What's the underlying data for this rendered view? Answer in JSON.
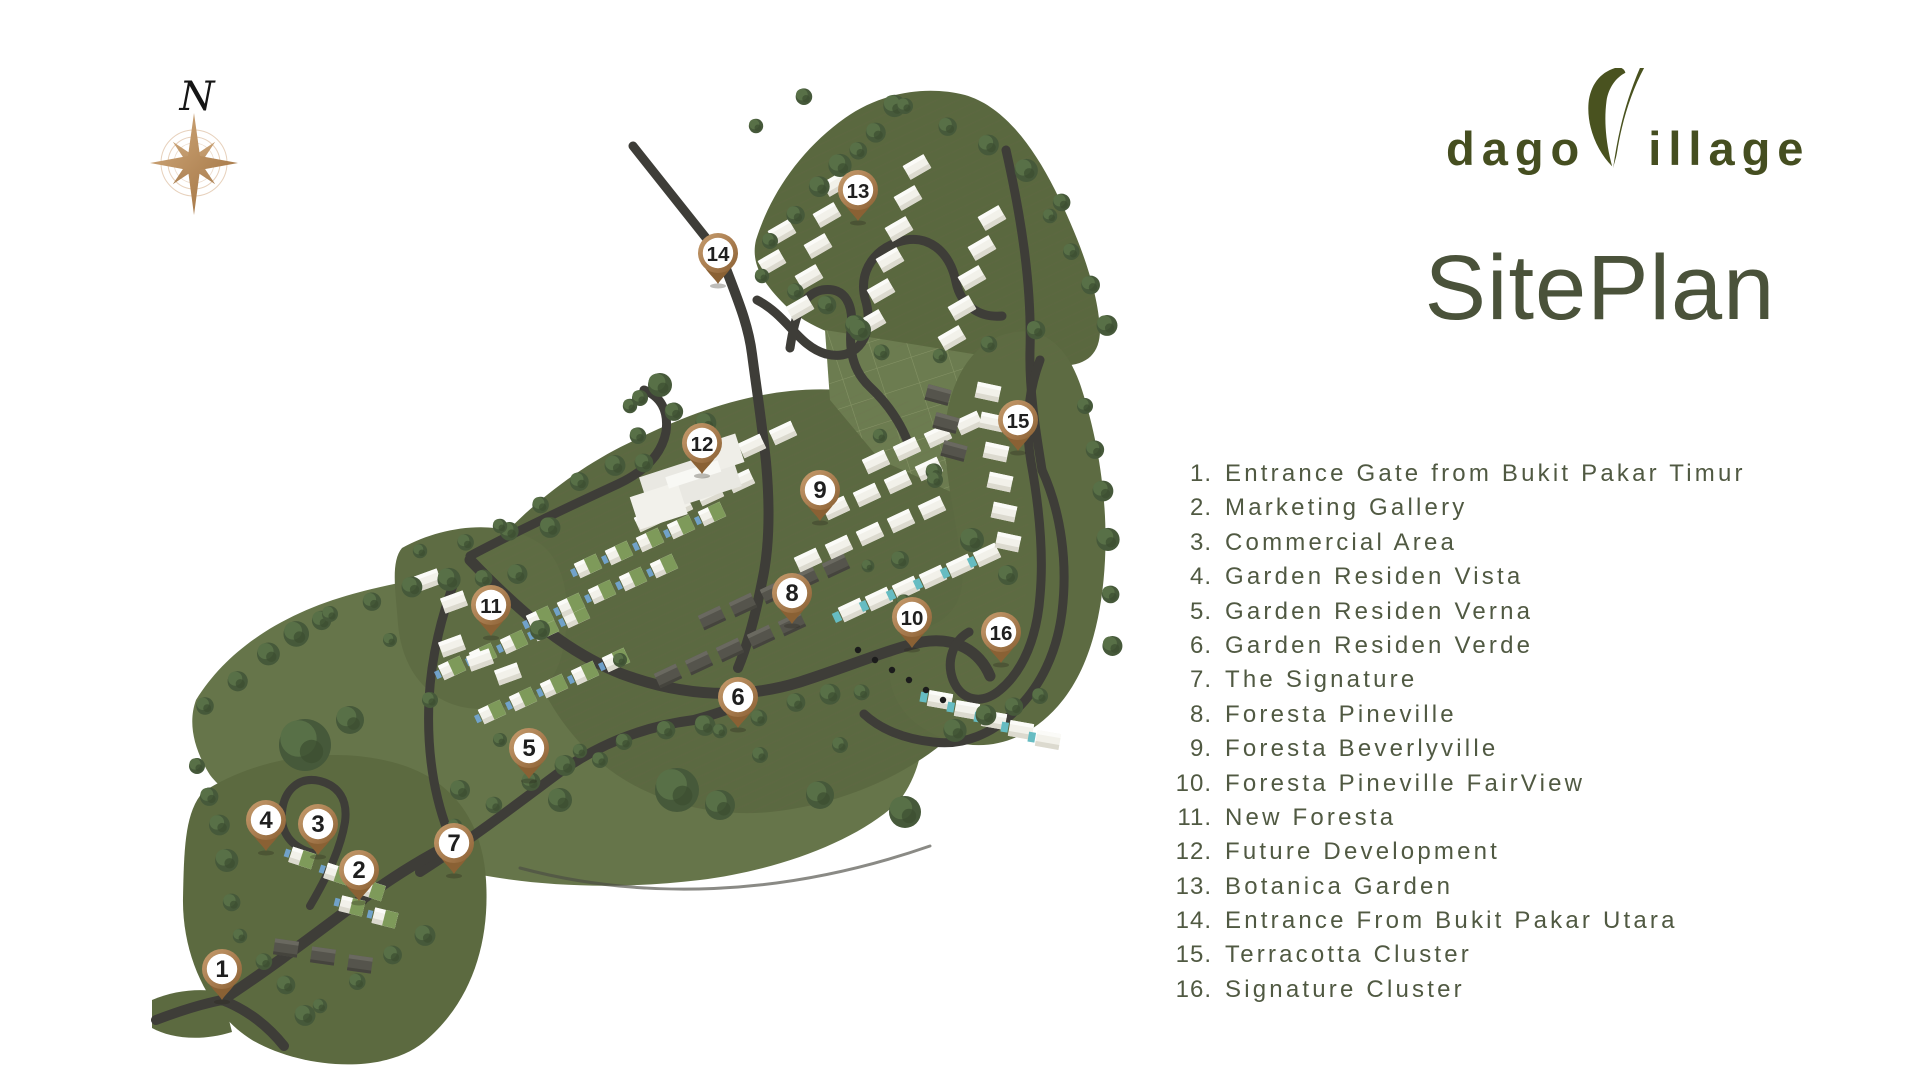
{
  "compass": {
    "label": "N"
  },
  "brand": {
    "logo_prefix": "dago",
    "logo_suffix": "illage",
    "title": "SitePlan"
  },
  "colors": {
    "brand_green": "#4a5228",
    "title_green": "#4a523a",
    "legend_green": "#505942",
    "pin_bronze": "#a87c4f",
    "pin_bronze_dark": "#8a6134",
    "road_gray": "#3e3d38",
    "terrain_green": "#5d6b41",
    "compass_bronze": "#bd8a58"
  },
  "legend": {
    "items": [
      {
        "num": "1.",
        "label": "Entrance Gate from Bukit Pakar Timur"
      },
      {
        "num": "2.",
        "label": "Marketing Gallery"
      },
      {
        "num": "3.",
        "label": "Commercial Area"
      },
      {
        "num": "4.",
        "label": "Garden Residen Vista"
      },
      {
        "num": "5.",
        "label": "Garden Residen Verna"
      },
      {
        "num": "6.",
        "label": "Garden Residen Verde"
      },
      {
        "num": "7.",
        "label": "The Signature"
      },
      {
        "num": "8.",
        "label": "Foresta Pineville"
      },
      {
        "num": "9.",
        "label": "Foresta Beverlyville"
      },
      {
        "num": "10.",
        "label": "Foresta  Pineville FairView"
      },
      {
        "num": "11.",
        "label": "New Foresta"
      },
      {
        "num": "12.",
        "label": "Future Development"
      },
      {
        "num": "13.",
        "label": "Botanica Garden"
      },
      {
        "num": "14.",
        "label": "Entrance From Bukit Pakar Utara"
      },
      {
        "num": "15.",
        "label": "Terracotta Cluster"
      },
      {
        "num": "16.",
        "label": "Signature Cluster"
      }
    ]
  },
  "map": {
    "markers": [
      {
        "number": "1",
        "x": 222,
        "y": 969
      },
      {
        "number": "2",
        "x": 359,
        "y": 870
      },
      {
        "number": "3",
        "x": 318,
        "y": 824
      },
      {
        "number": "4",
        "x": 266,
        "y": 820
      },
      {
        "number": "5",
        "x": 529,
        "y": 748
      },
      {
        "number": "6",
        "x": 738,
        "y": 697
      },
      {
        "number": "7",
        "x": 454,
        "y": 843
      },
      {
        "number": "8",
        "x": 792,
        "y": 593
      },
      {
        "number": "9",
        "x": 820,
        "y": 490
      },
      {
        "number": "10",
        "x": 912,
        "y": 617
      },
      {
        "number": "11",
        "x": 491,
        "y": 605
      },
      {
        "number": "12",
        "x": 702,
        "y": 443
      },
      {
        "number": "13",
        "x": 858,
        "y": 190
      },
      {
        "number": "14",
        "x": 718,
        "y": 253
      },
      {
        "number": "15",
        "x": 1018,
        "y": 420
      },
      {
        "number": "16",
        "x": 1001,
        "y": 632
      }
    ]
  }
}
